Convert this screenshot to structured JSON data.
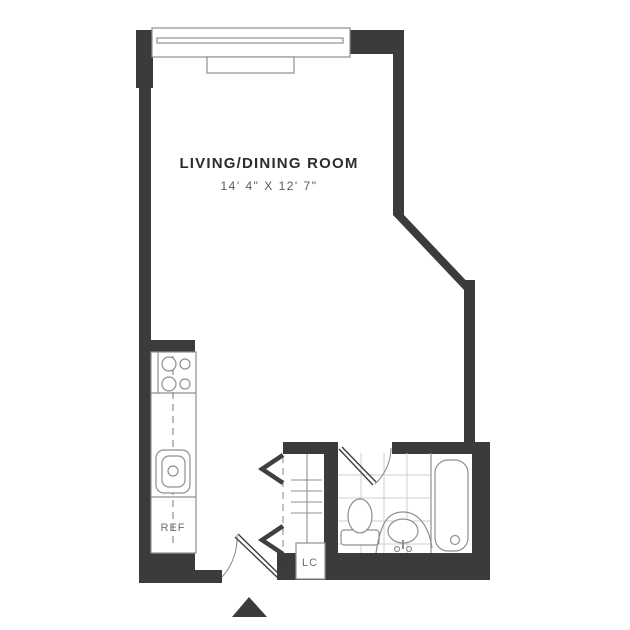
{
  "floor_plan": {
    "title": "Studio apartment floor plan",
    "room": {
      "label": "LIVING/DINING ROOM",
      "dimensions": "14' 4\" X 12' 7\""
    },
    "kitchen": {
      "refrigerator_label": "REF",
      "fixtures": [
        "range-4-burner",
        "counter",
        "sink",
        "refrigerator"
      ]
    },
    "closet": {
      "label": "LC",
      "type": "linen-closet",
      "features": [
        "bifold-doors",
        "shelves"
      ]
    },
    "bathroom": {
      "fixtures": [
        "toilet",
        "pedestal-sink",
        "bathtub"
      ],
      "floor": "tile-grid",
      "door": "swing-door"
    },
    "entry": {
      "door": "swing-door",
      "marker": "entry-triangle"
    },
    "window": {
      "location": "top-wall",
      "parts": [
        "frame",
        "glass",
        "sill"
      ]
    }
  },
  "colors": {
    "wall": "#3b3b3b",
    "fixture_line": "#8f8f8f",
    "tile_line": "#cfcfcf",
    "door_line": "#3f3f3f",
    "label_text": "#2d2d2d",
    "dimension_text": "#5a5a5a",
    "fixture_text": "#6e6e6e",
    "background": "#ffffff"
  }
}
